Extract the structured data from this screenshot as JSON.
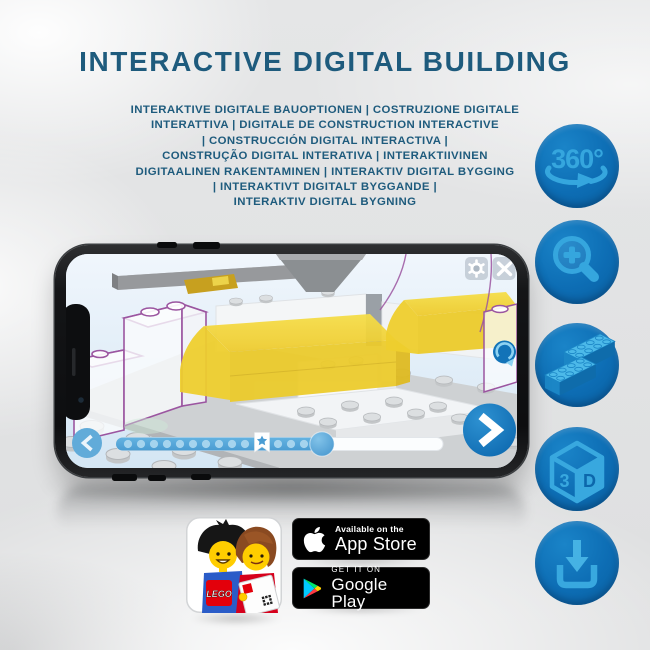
{
  "header": {
    "title": "INTERACTIVE DIGITAL BUILDING",
    "subtitle": "INTERAKTIVE DIGITALE BAUOPTIONEN | COSTRUZIONE DIGITALE\nINTERATTIVA | DIGITALE DE CONSTRUCTION INTERACTIVE\n| CONSTRUCCIÓN DIGITAL INTERACTIVA |\nCONSTRUÇÃO DIGITAL INTERATIVA | INTERAKTIIVINEN\nDIGITAALINEN RAKENTAMINEN | INTERAKTIV DIGITAL BYGGING\n| INTERAKTIVT DIGITALT BYGGANDE |\nINTERAKTIV DIGITAL BYGNING"
  },
  "features": {
    "rotate360_label": "360°",
    "cube_left_face": "3",
    "cube_right_face": "D",
    "items": [
      "360-degree-rotation",
      "zoom-in",
      "lego-brick",
      "3d-view",
      "download"
    ]
  },
  "store_badges": {
    "app_store": {
      "tagline": "Available on the",
      "name": "App Store"
    },
    "google_play": {
      "tagline": "GET IT ON",
      "name": "Google Play"
    }
  },
  "app_icon": {
    "brand": "LEGO"
  },
  "colors": {
    "heading_blue": "#1E5B7D",
    "icon_circle_blue": "#0D6DB6",
    "icon_glyph_blue": "#35A6DE",
    "app_accent_blue": "#0E72B9",
    "slider_blue": "#55A6D8",
    "brick_yellow": "#F0D034",
    "ghost_outline_purple": "#9B55A0",
    "phone_frame": "#111214"
  }
}
